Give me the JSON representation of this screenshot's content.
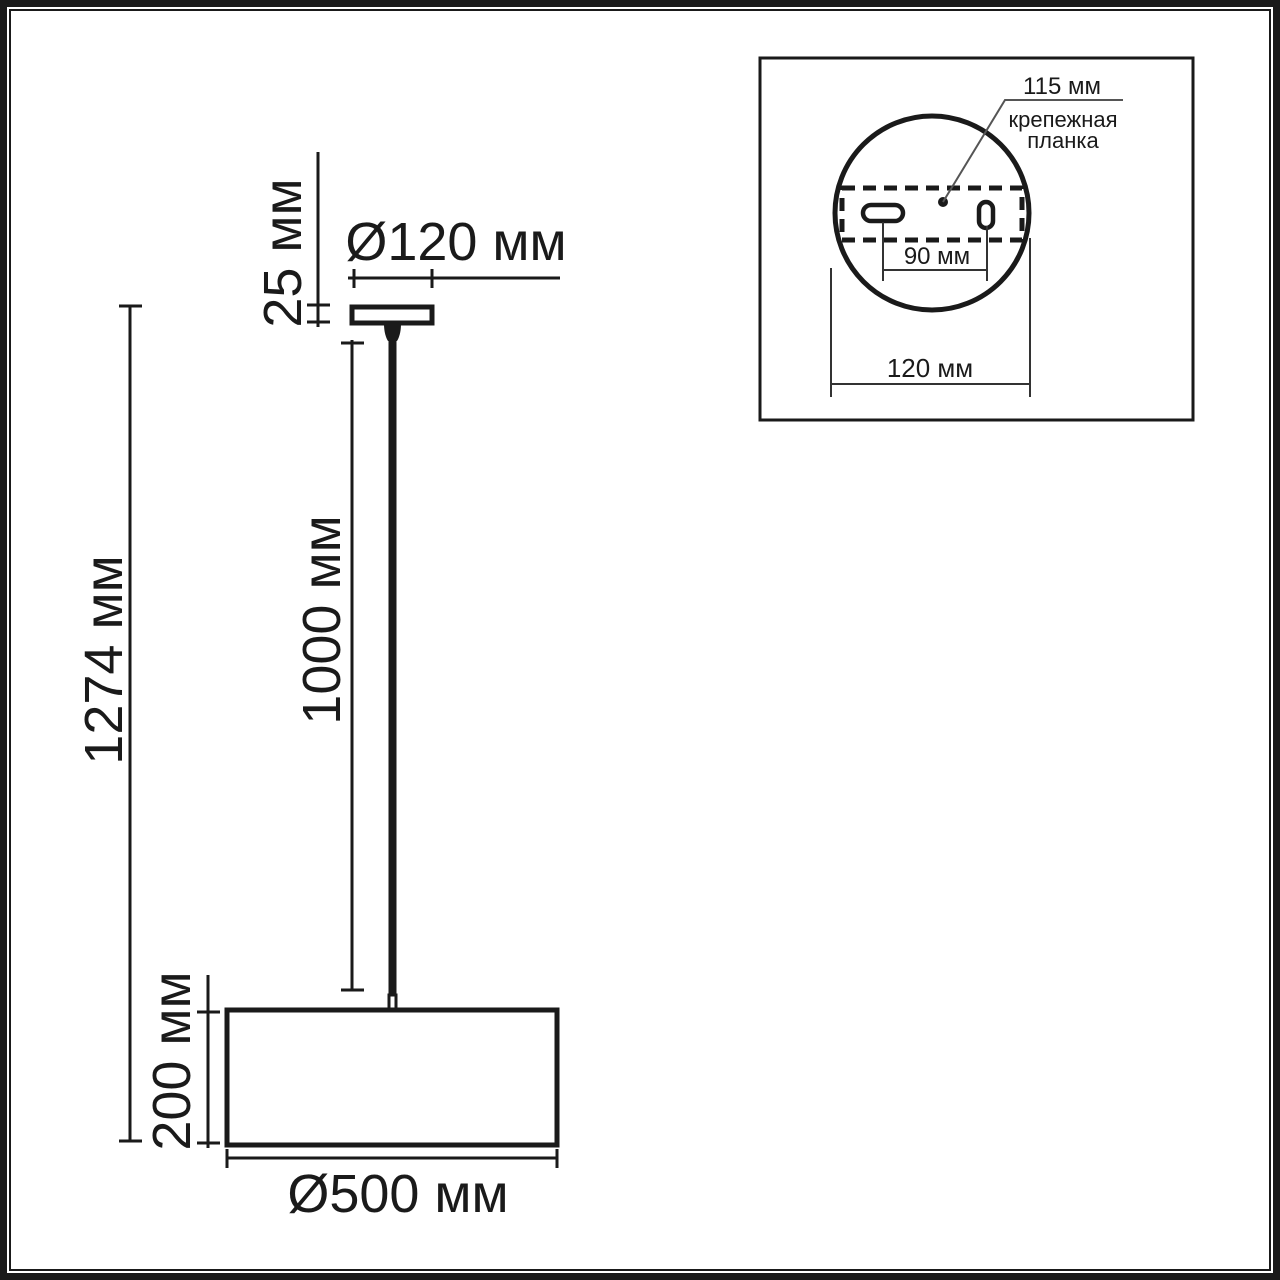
{
  "page": {
    "background": "#ffffff",
    "line_color": "#1a1a1a",
    "leader_color": "#555555",
    "unit": "мм"
  },
  "main_view": {
    "overall_height_label": "1274 мм",
    "canopy_height_label": "25 мм",
    "canopy_diameter_label": "Ø120 мм",
    "rod_length_label": "1000 мм",
    "shade_height_label": "200 мм",
    "shade_diameter_label": "Ø500 мм"
  },
  "inset_view": {
    "plate_length_label": "115 мм",
    "plate_name_line1": "крепежная",
    "plate_name_line2": "планка",
    "hole_spacing_label": "90 мм",
    "base_diameter_label": "120 мм"
  }
}
